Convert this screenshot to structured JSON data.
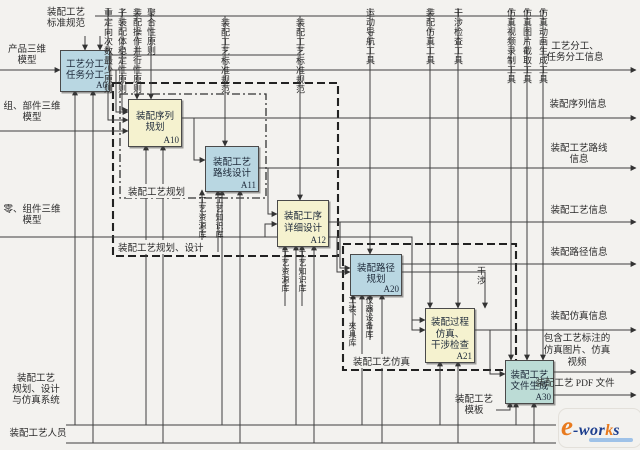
{
  "diagram": {
    "boxes": {
      "a0": {
        "l1": "工艺分工",
        "l2": "任务分工",
        "code": "A0"
      },
      "a10": {
        "l1": "装配序列",
        "l2": "规划",
        "code": "A10"
      },
      "a11": {
        "l1": "装配工艺",
        "l2": "路线设计",
        "code": "A11"
      },
      "a12": {
        "l1": "装配工序",
        "l2": "详细设计",
        "code": "A12"
      },
      "a20": {
        "l1": "装配路径",
        "l2": "规划",
        "code": "A20"
      },
      "a21": {
        "l1": "装配过程",
        "l2": "仿真、",
        "l3": "干涉检查",
        "code": "A21"
      },
      "a30": {
        "l1": "装配工艺",
        "l2": "文件生成",
        "code": "A30"
      }
    },
    "inputs": {
      "product_model": {
        "l1": "产品三维",
        "l2": "模型"
      },
      "assembly_model": {
        "l1": "组、部件三维",
        "l2": "模型"
      },
      "part_model": {
        "l1": "零、组件三维",
        "l2": "模型"
      }
    },
    "controls": {
      "std_spec_main": {
        "l1": "装配工艺",
        "l2": "标准规范"
      },
      "principle_reorient": "重定向次数最少原则",
      "principle_stability": "子装配体稳定性原则",
      "principle_parallel": "装配操作并行性原则",
      "principle_aggregation": "聚合性原则",
      "std_spec_2": "装配工艺标准规范",
      "std_spec_3": "装配工艺标准规范",
      "tool_motion_nav": "运动导航工具",
      "tool_assembly_sim": "装配仿真工具",
      "tool_interference_check": "干涉检查工具",
      "tool_sim_video": "仿真视频录制工具",
      "tool_sim_image": "仿真图片截取工具",
      "tool_sim_animation": "仿真动画生成工具"
    },
    "outputs": {
      "task_info": {
        "l1": "工艺分工、",
        "l2": "任务分工信息"
      },
      "sequence_info": "装配序列信息",
      "route_info": {
        "l1": "装配工艺路线",
        "l2": "信息"
      },
      "process_info": "装配工艺信息",
      "path_info": "装配路径信息",
      "sim_info": "装配仿真信息",
      "sim_media": {
        "l1": "包含工艺标注的",
        "l2": "仿真图片、仿真",
        "l3": "视频"
      },
      "pdf_file": "装配工艺 PDF 文件"
    },
    "mechanisms": {
      "system": {
        "l1": "装配工艺",
        "l2": "规划、设计",
        "l3": "与仿真系统"
      },
      "personnel": "装配工艺人员",
      "template": {
        "l1": "装配工艺",
        "l2": "模板"
      }
    },
    "resources": {
      "res_lib_1": "工艺资源库",
      "know_lib_1": "工艺知识库",
      "res_lib_2": "工艺资源库",
      "know_lib_2": "工艺知识库",
      "fixture_lib": "工装、夹具库",
      "equipment_lib": "仪器设备库"
    },
    "groups": {
      "planning": "装配工艺规划",
      "planning_design": "装配工艺规划、设计",
      "simulation": "装配工艺仿真"
    },
    "feedback": {
      "interference": "干涉"
    },
    "logo": {
      "e": "e",
      "hyphen_wor": "-wor",
      "k": "k",
      "s": "s"
    }
  },
  "colors": {
    "box_blue": "#b9d7e2",
    "box_yellow": "#f5f2cf",
    "box_teal": "#bcdcd6",
    "line": "#3f3f3f",
    "background": "#f3f2ef",
    "logo_orange": "#e87a1e",
    "logo_blue": "#1c3e8e"
  }
}
